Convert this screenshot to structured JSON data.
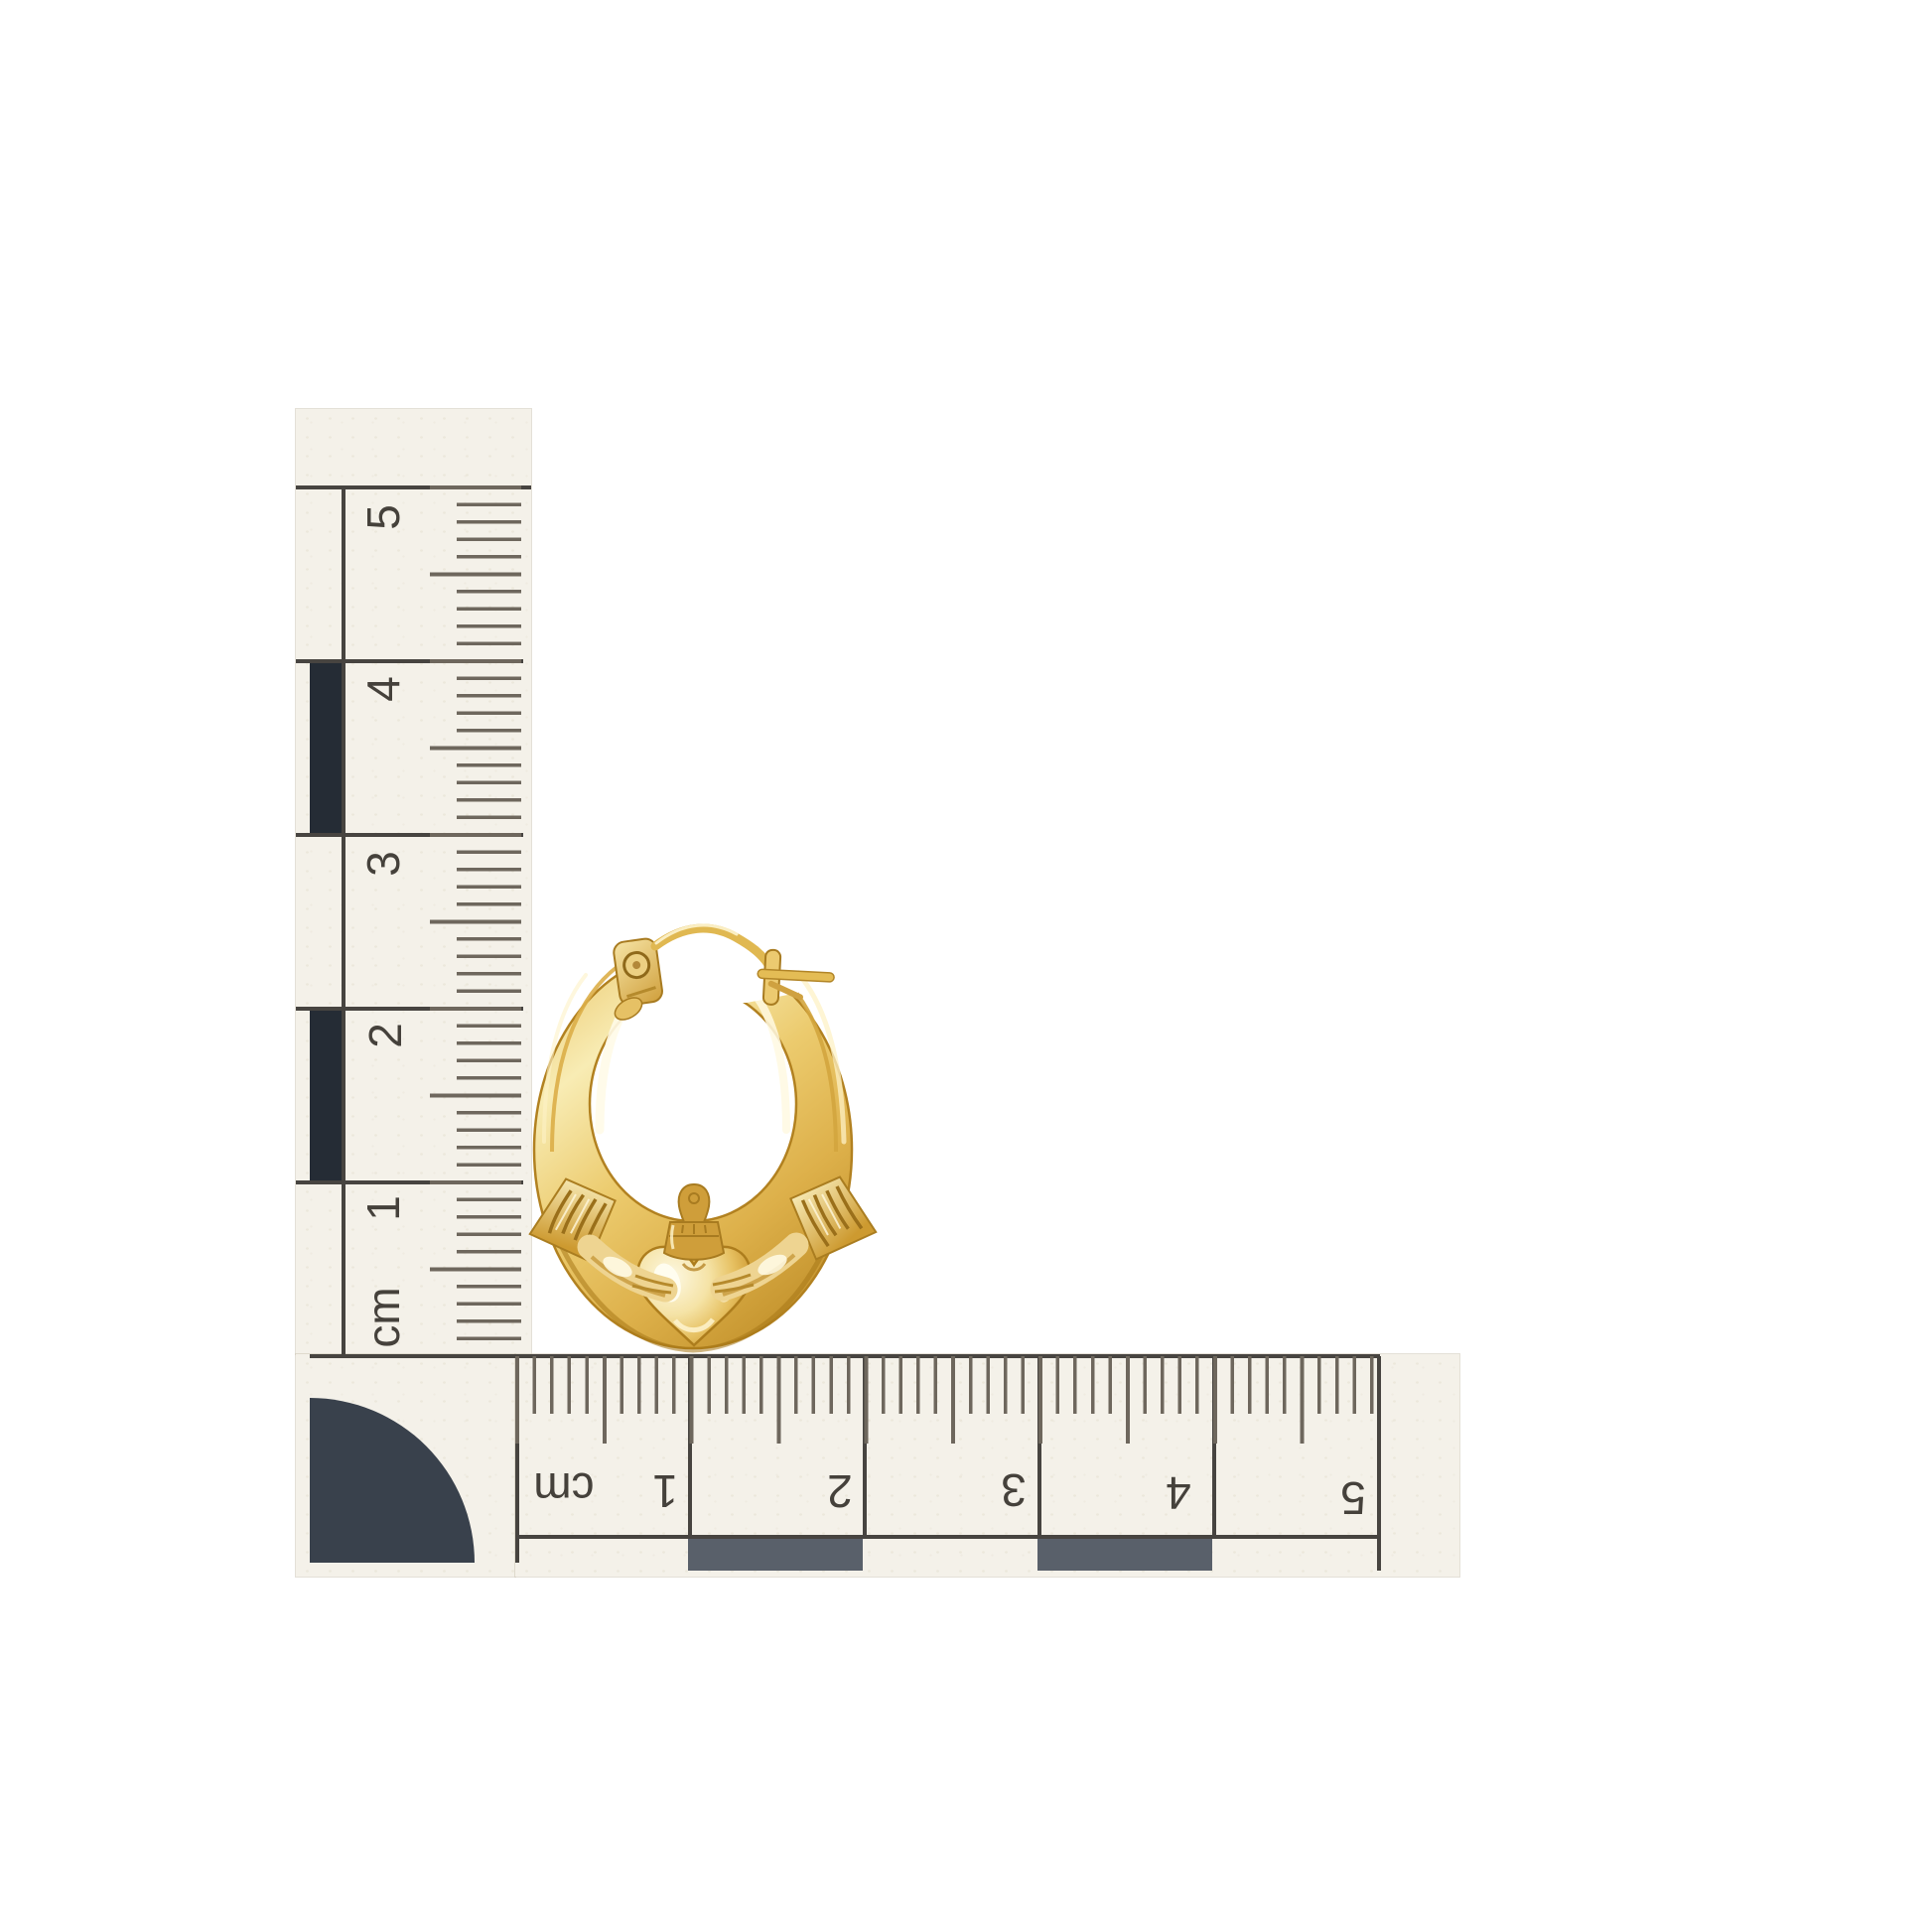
{
  "meta": {
    "description": "Product photograph of a yellow-gold Claddagh hoop earring beside an L-shaped centimetre photo scale on a white background",
    "background_color": "#ffffff"
  },
  "scale_rulers": {
    "unit": "cm",
    "millimeters_per_centimeter": 10,
    "span_cm": 5,
    "ink_color": "#474440",
    "tick_color": "#6e675d",
    "paper_color": "#f4f1e9",
    "vertical": {
      "labels": [
        "5",
        "4",
        "3",
        "2",
        "1",
        "cm"
      ],
      "label_rotation_deg": -90,
      "dark_band_color": "#252c35",
      "dark_band_segments": [
        "4-3",
        "2-1"
      ]
    },
    "horizontal": {
      "labels": [
        "cm",
        "1",
        "2",
        "3",
        "4",
        "5"
      ],
      "label_rotation_deg": 180,
      "dark_band_color": "#59606a",
      "dark_band_segments": [
        "1-2",
        "3-4"
      ]
    },
    "corner_mark": {
      "shape": "quarter-circle",
      "color": "#39414c"
    }
  },
  "subject": {
    "name": "gold claddagh hoop earring",
    "material_colors": {
      "highlight": "#fdf6d8",
      "light_gold": "#f4e2a4",
      "mid_gold": "#e9c468",
      "deep_gold": "#c9962f",
      "shadow_gold": "#a87818"
    },
    "parts": [
      "tapered hoop tube",
      "hinge tab with rivet",
      "clasp wire",
      "latch catch with pin",
      "ribbed crown cuff left",
      "ribbed crown cuff right",
      "hand left",
      "hand right",
      "crown",
      "heart"
    ],
    "approx_size_on_scale_cm": {
      "width": 1.8,
      "height": 2.4
    }
  }
}
